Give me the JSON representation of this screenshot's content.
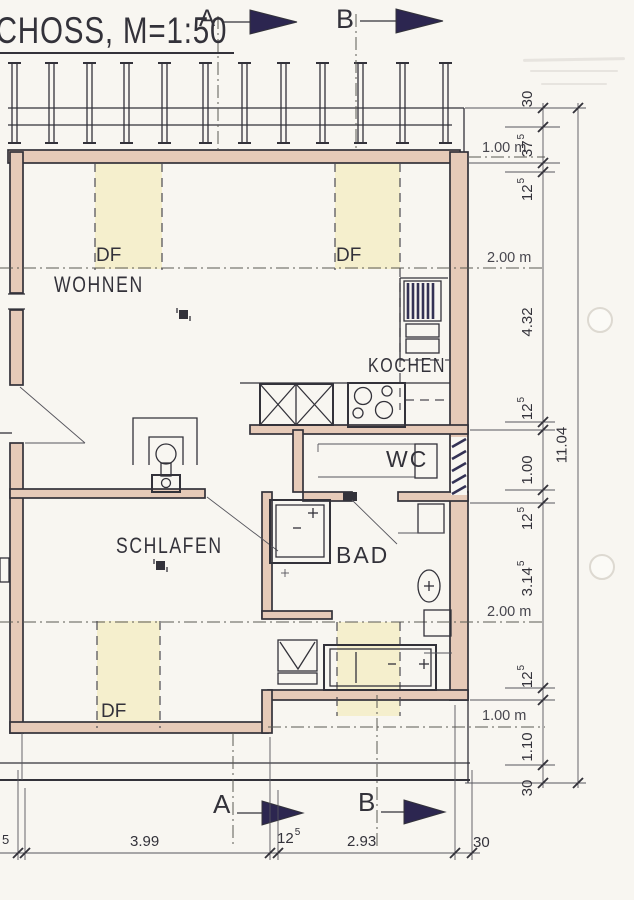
{
  "title": {
    "text": "CHOSS, M=1:50"
  },
  "sections": {
    "top_a": "A",
    "top_b": "B",
    "bottom_a": "A",
    "bottom_b": "B"
  },
  "rooms": {
    "wohnen": "WOHNEN",
    "kochen": "KOCHEN",
    "wc": "WC",
    "schlafen": "SCHLAFEN",
    "bad": "BAD"
  },
  "df_label": "DF",
  "height_lines": [
    "1.00 m",
    "2.00 m",
    "2.00 m",
    "1.00 m"
  ],
  "dims_right": [
    {
      "main": "30"
    },
    {
      "main": "37",
      "sup": "5"
    },
    {
      "main": "12",
      "sup": "5"
    },
    {
      "main": "4.32"
    },
    {
      "main": "12",
      "sup": "5"
    },
    {
      "main": "1.00"
    },
    {
      "main": "12",
      "sup": "5"
    },
    {
      "main": "3.14",
      "sup": "5"
    },
    {
      "main": "12",
      "sup": "5"
    },
    {
      "main": "1.10"
    },
    {
      "main": "30"
    }
  ],
  "dims_right_total": {
    "main": "11.04"
  },
  "dims_bottom": [
    {
      "main": "5"
    },
    {
      "main": "3.99"
    },
    {
      "main": "12",
      "sup": "5"
    },
    {
      "main": "2.93"
    },
    {
      "main": "30"
    }
  ],
  "colors": {
    "paper": "#f8f6f1",
    "ink": "#33323a",
    "wall": "#e6cab8",
    "win": "#f5efcd",
    "arrow": "#2c2650",
    "hline": "#5a5952"
  }
}
